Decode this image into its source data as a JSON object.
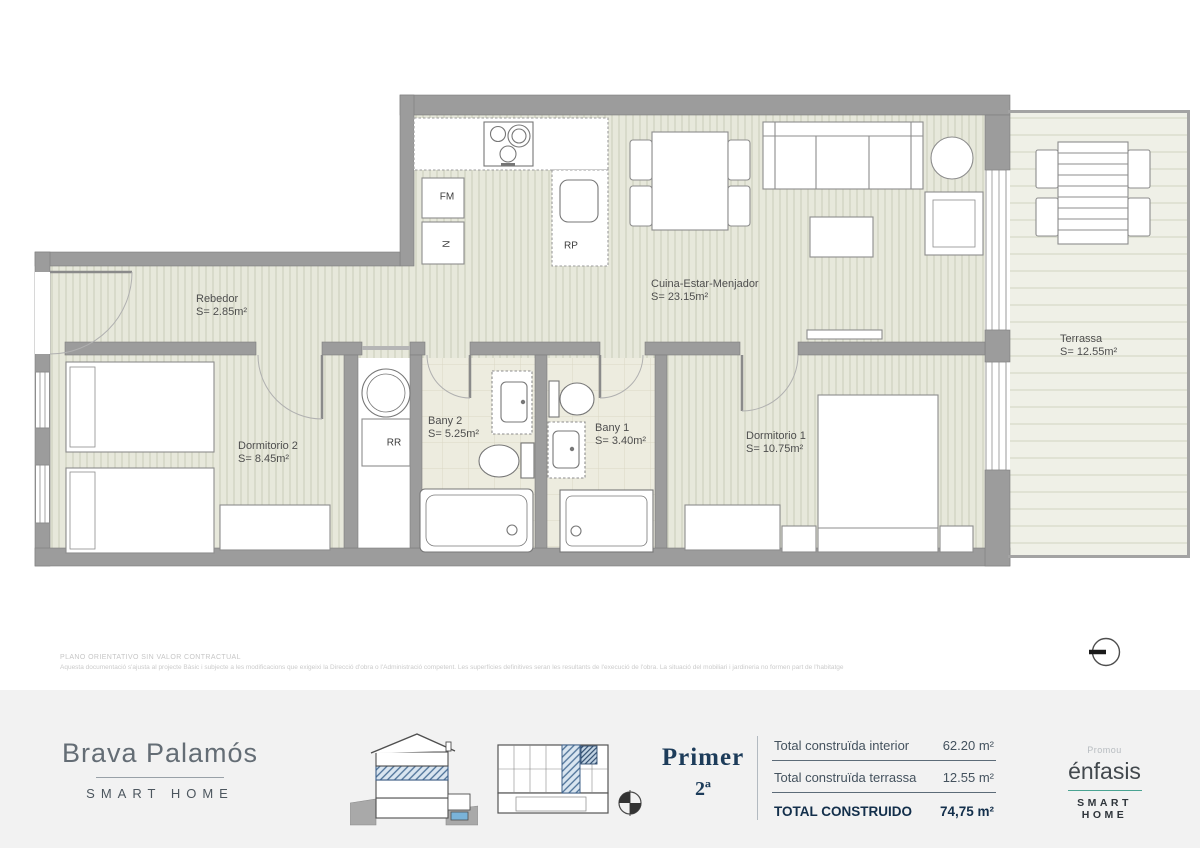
{
  "plan": {
    "rooms": [
      {
        "id": "rebedor",
        "name": "Rebedor",
        "area": "S= 2.85m²"
      },
      {
        "id": "cuina",
        "name": "Cuina-Estar-Menjador",
        "area": "S= 23.15m²"
      },
      {
        "id": "terrassa",
        "name": "Terrassa",
        "area": "S= 12.55m²"
      },
      {
        "id": "dormitorio2",
        "name": "Dormitorio 2",
        "area": "S= 8.45m²"
      },
      {
        "id": "bany2",
        "name": "Bany 2",
        "area": "S= 5.25m²"
      },
      {
        "id": "bany1",
        "name": "Bany 1",
        "area": "S= 3.40m²"
      },
      {
        "id": "dormitorio1",
        "name": "Dormitorio 1",
        "area": "S= 10.75m²"
      }
    ],
    "tags": {
      "fm": "FM",
      "n": "N",
      "rp": "RP",
      "rr": "RR"
    }
  },
  "disclaimer": {
    "line1": "PLANO ORIENTATIVO SIN VALOR CONTRACTUAL",
    "line2": "Aquesta documentació s'ajusta al projecte Bàsic i subjecte a les modificacions que exigeixi la Direcció d'obra o l'Administració competent. Les superfícies definitives seran les resultants de l'execució de l'obra. La situació del mobiliari i jardineria no formen part de l'habitatge"
  },
  "footer": {
    "brand": {
      "name": "Brava Palamós",
      "tagline": "SMART HOME"
    },
    "floor": {
      "title": "Primer",
      "unit": "2ª"
    },
    "totals": {
      "rows": [
        {
          "label": "Total construïda interior",
          "value": "62.20 m²"
        },
        {
          "label": "Total construïda terrassa",
          "value": "12.55 m²"
        }
      ],
      "total": {
        "label": "TOTAL CONSTRUIDO",
        "value": "74,75 m²"
      }
    },
    "developer": {
      "promou": "Promou",
      "name": "énfasis",
      "tagline": "SMART HOME"
    }
  },
  "colors": {
    "wall": "#9c9c9c",
    "floor_stripe": "#e7e8db",
    "terrace": "#eff0e7",
    "navy_accent": "#1d3c5a",
    "teal_accent": "#4aa392",
    "highlight_hatch": "#4a6f96",
    "footer_bg": "#f2f2f2"
  }
}
